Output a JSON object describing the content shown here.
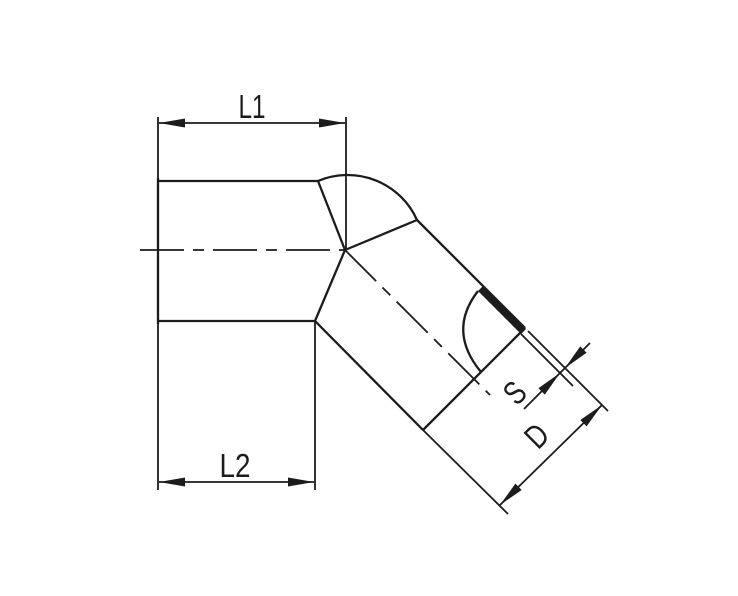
{
  "drawing": {
    "labels": {
      "l1": "L1",
      "l2": "L2",
      "s": "S",
      "d": "D"
    },
    "colors": {
      "line": "#1c1c1c",
      "background": "#ffffff"
    }
  }
}
